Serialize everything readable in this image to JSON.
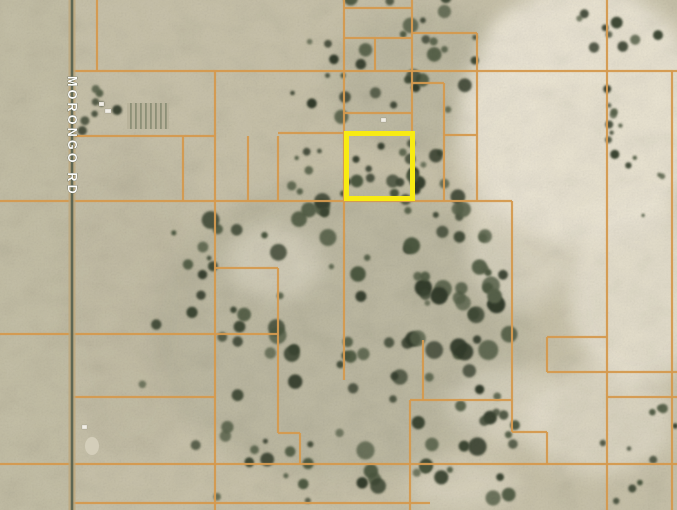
{
  "map": {
    "road_label": "MORONGO RD",
    "colors": {
      "terrain": "#c9c3ab",
      "terrain_left_tint": "#b8b39c",
      "wash_light": "#ece6d5",
      "parcel_line": "#d59a4f",
      "highlight": "#f8eb13",
      "road": "#5e6754",
      "road_shoulder": "#bfa87c",
      "label_text": "#fdfdfb",
      "label_halo": "#3f4838",
      "building": "#f2efe6",
      "veg_palette": [
        "#566049",
        "#49543c",
        "#3b4531",
        "#313a29"
      ]
    },
    "highlight_parcel": {
      "x": 346.5,
      "y": 133.5,
      "width": 66,
      "height": 65,
      "stroke_width": 5
    },
    "road": {
      "x": 72,
      "width": 2.6,
      "shoulder_width": 7
    },
    "parcel_lines": {
      "horizontal": [
        [
          8,
          344,
          412
        ],
        [
          33,
          412,
          477
        ],
        [
          38,
          344,
          412
        ],
        [
          71,
          72,
          677
        ],
        [
          83,
          412,
          444
        ],
        [
          113,
          344,
          412
        ],
        [
          133,
          278,
          344
        ],
        [
          135,
          444,
          477
        ],
        [
          136,
          72,
          215
        ],
        [
          201,
          0,
          512
        ],
        [
          268,
          215,
          278
        ],
        [
          334,
          0,
          278
        ],
        [
          337,
          547,
          607
        ],
        [
          372,
          547,
          677
        ],
        [
          397,
          72,
          215
        ],
        [
          397,
          607,
          677
        ],
        [
          400,
          410,
          512
        ],
        [
          432,
          512,
          547
        ],
        [
          433,
          278,
          300
        ],
        [
          464,
          0,
          677
        ],
        [
          503,
          72,
          430
        ]
      ],
      "vertical": [
        [
          97,
          0,
          71
        ],
        [
          183,
          136,
          201
        ],
        [
          215,
          71,
          510
        ],
        [
          248,
          136,
          201
        ],
        [
          278,
          136,
          201
        ],
        [
          278,
          268,
          433
        ],
        [
          300,
          433,
          464
        ],
        [
          344,
          0,
          380
        ],
        [
          375,
          38,
          71
        ],
        [
          412,
          0,
          131
        ],
        [
          444,
          83,
          201
        ],
        [
          477,
          33,
          201
        ],
        [
          423,
          340,
          400
        ],
        [
          410,
          400,
          510
        ],
        [
          512,
          201,
          432
        ],
        [
          547,
          337,
          372
        ],
        [
          547,
          432,
          464
        ],
        [
          607,
          0,
          510
        ],
        [
          672,
          71,
          510
        ]
      ]
    },
    "tint_areas": [
      [
        340,
        330,
        190,
        150,
        "#a8a893",
        0.32
      ],
      [
        420,
        80,
        95,
        75,
        "#a8a893",
        0.28
      ],
      [
        130,
        300,
        70,
        160,
        "#b4ae97",
        0.22
      ]
    ],
    "wash_areas": [
      [
        585,
        115,
        120,
        130,
        0.95
      ],
      [
        548,
        45,
        60,
        40,
        0.8
      ],
      [
        500,
        140,
        45,
        80,
        0.6
      ],
      [
        638,
        290,
        70,
        95,
        0.8
      ],
      [
        600,
        420,
        75,
        55,
        0.55
      ],
      [
        520,
        240,
        55,
        70,
        0.5
      ],
      [
        275,
        262,
        48,
        36,
        0.45
      ],
      [
        505,
        405,
        55,
        40,
        0.45
      ],
      [
        465,
        485,
        55,
        28,
        0.4
      ]
    ],
    "vegetation_clusters": [
      {
        "cx": 408,
        "cy": 55,
        "rx": 68,
        "ry": 62,
        "count": 26,
        "rmin": 2.5,
        "rmax": 8
      },
      {
        "cx": 318,
        "cy": 75,
        "rx": 28,
        "ry": 45,
        "count": 7,
        "rmin": 2,
        "rmax": 5
      },
      {
        "cx": 615,
        "cy": 28,
        "rx": 65,
        "ry": 26,
        "count": 9,
        "rmin": 3,
        "rmax": 7
      },
      {
        "cx": 614,
        "cy": 130,
        "rx": 7,
        "ry": 48,
        "count": 8,
        "rmin": 2,
        "rmax": 5
      },
      {
        "cx": 350,
        "cy": 270,
        "rx": 150,
        "ry": 75,
        "count": 46,
        "rmin": 2.5,
        "rmax": 9
      },
      {
        "cx": 400,
        "cy": 420,
        "rx": 110,
        "ry": 85,
        "count": 40,
        "rmin": 3,
        "rmax": 10
      },
      {
        "cx": 205,
        "cy": 350,
        "rx": 70,
        "ry": 120,
        "count": 14,
        "rmin": 2,
        "rmax": 6
      },
      {
        "cx": 100,
        "cy": 112,
        "rx": 28,
        "ry": 26,
        "count": 9,
        "rmin": 2.5,
        "rmax": 5.5
      },
      {
        "cx": 645,
        "cy": 450,
        "rx": 45,
        "ry": 55,
        "count": 10,
        "rmin": 2,
        "rmax": 5
      },
      {
        "cx": 648,
        "cy": 165,
        "rx": 30,
        "ry": 60,
        "count": 6,
        "rmin": 1.5,
        "rmax": 3.5
      },
      {
        "cx": 378,
        "cy": 170,
        "rx": 38,
        "ry": 32,
        "count": 10,
        "rmin": 2.5,
        "rmax": 7
      },
      {
        "cx": 265,
        "cy": 465,
        "rx": 55,
        "ry": 40,
        "count": 12,
        "rmin": 2.5,
        "rmax": 7
      },
      {
        "cx": 455,
        "cy": 320,
        "rx": 55,
        "ry": 60,
        "count": 16,
        "rmin": 3,
        "rmax": 9
      },
      {
        "cx": 500,
        "cy": 430,
        "rx": 40,
        "ry": 40,
        "count": 8,
        "rmin": 2,
        "rmax": 6
      },
      {
        "cx": 432,
        "cy": 165,
        "rx": 30,
        "ry": 32,
        "count": 12,
        "rmin": 2.5,
        "rmax": 7
      },
      {
        "cx": 315,
        "cy": 175,
        "rx": 30,
        "ry": 28,
        "count": 7,
        "rmin": 2,
        "rmax": 5
      }
    ],
    "structures": {
      "orchard_block": [
        127,
        103,
        42,
        26
      ],
      "buildings": [
        [
          99,
          102,
          5,
          4
        ],
        [
          105,
          109,
          6,
          4
        ],
        [
          381,
          118,
          5,
          4
        ],
        [
          82,
          425,
          5,
          4
        ]
      ],
      "gray_patch": [
        92,
        446,
        7,
        9
      ]
    }
  }
}
